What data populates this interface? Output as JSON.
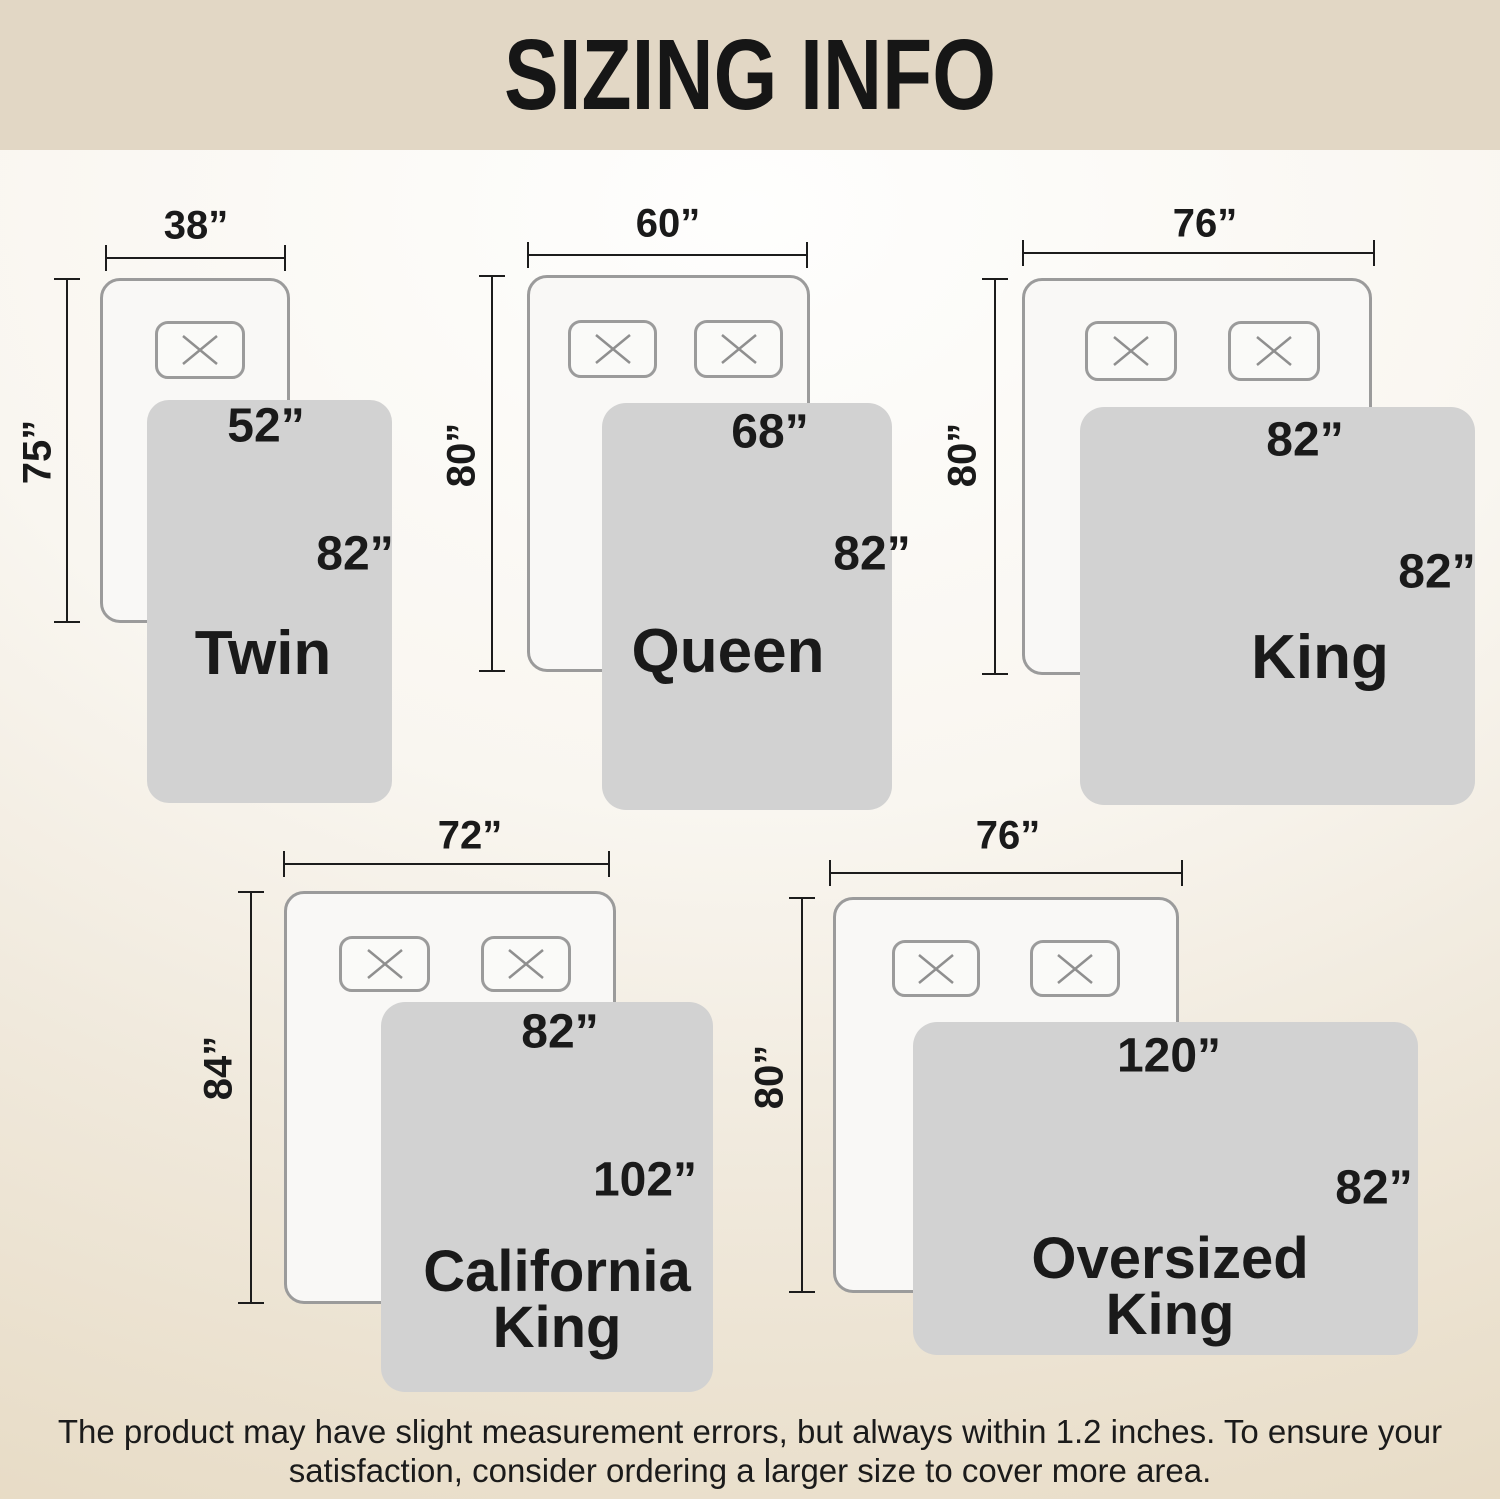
{
  "title": "SIZING INFO",
  "colors": {
    "banner_background": "#e2d7c5",
    "page_background_top": "#fefefd",
    "page_background_bottom": "#e7dbc5",
    "bed_fill": "#f9f8f6",
    "bed_border": "#9b9b9b",
    "blanket_fill": "#d2d2d2",
    "text": "#1a1a1a"
  },
  "sizes": [
    {
      "name_lines": [
        "Twin"
      ],
      "mattress_width": "38”",
      "mattress_length": "75”",
      "blanket_width": "52”",
      "blanket_length": "82”",
      "pillow_count": 1
    },
    {
      "name_lines": [
        "Queen"
      ],
      "mattress_width": "60”",
      "mattress_length": "80”",
      "blanket_width": "68”",
      "blanket_length": "82”",
      "pillow_count": 2
    },
    {
      "name_lines": [
        "King"
      ],
      "mattress_width": "76”",
      "mattress_length": "80”",
      "blanket_width": "82”",
      "blanket_length": "82”",
      "pillow_count": 2
    },
    {
      "name_lines": [
        "California",
        "King"
      ],
      "mattress_width": "72”",
      "mattress_length": "84”",
      "blanket_width": "82”",
      "blanket_length": "102”",
      "pillow_count": 2
    },
    {
      "name_lines": [
        "Oversized",
        "King"
      ],
      "mattress_width": "76”",
      "mattress_length": "80”",
      "blanket_width": "120”",
      "blanket_length": "82”",
      "pillow_count": 2
    }
  ],
  "disclaimer": {
    "line1": "The product may have slight measurement errors, but always within 1.2 inches. To ensure your",
    "line2": "satisfaction, consider ordering a larger size to cover more area."
  }
}
